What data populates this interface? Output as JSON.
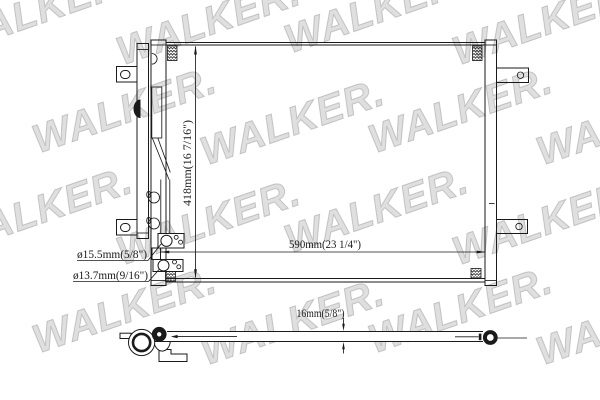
{
  "watermark": {
    "text": "WALKER."
  },
  "drawing": {
    "colors": {
      "line": "#1a1a1a",
      "watermark": "#b2b2b2",
      "background": "#ffffff"
    },
    "dimensions": {
      "height": "418mm(16 7/16\")",
      "width": "590mm(23 1/4\")",
      "port_large": "ø15.5mm(5/8\")",
      "port_small": "ø13.7mm(9/16\")",
      "depth": "16mm(5/8\")"
    }
  }
}
